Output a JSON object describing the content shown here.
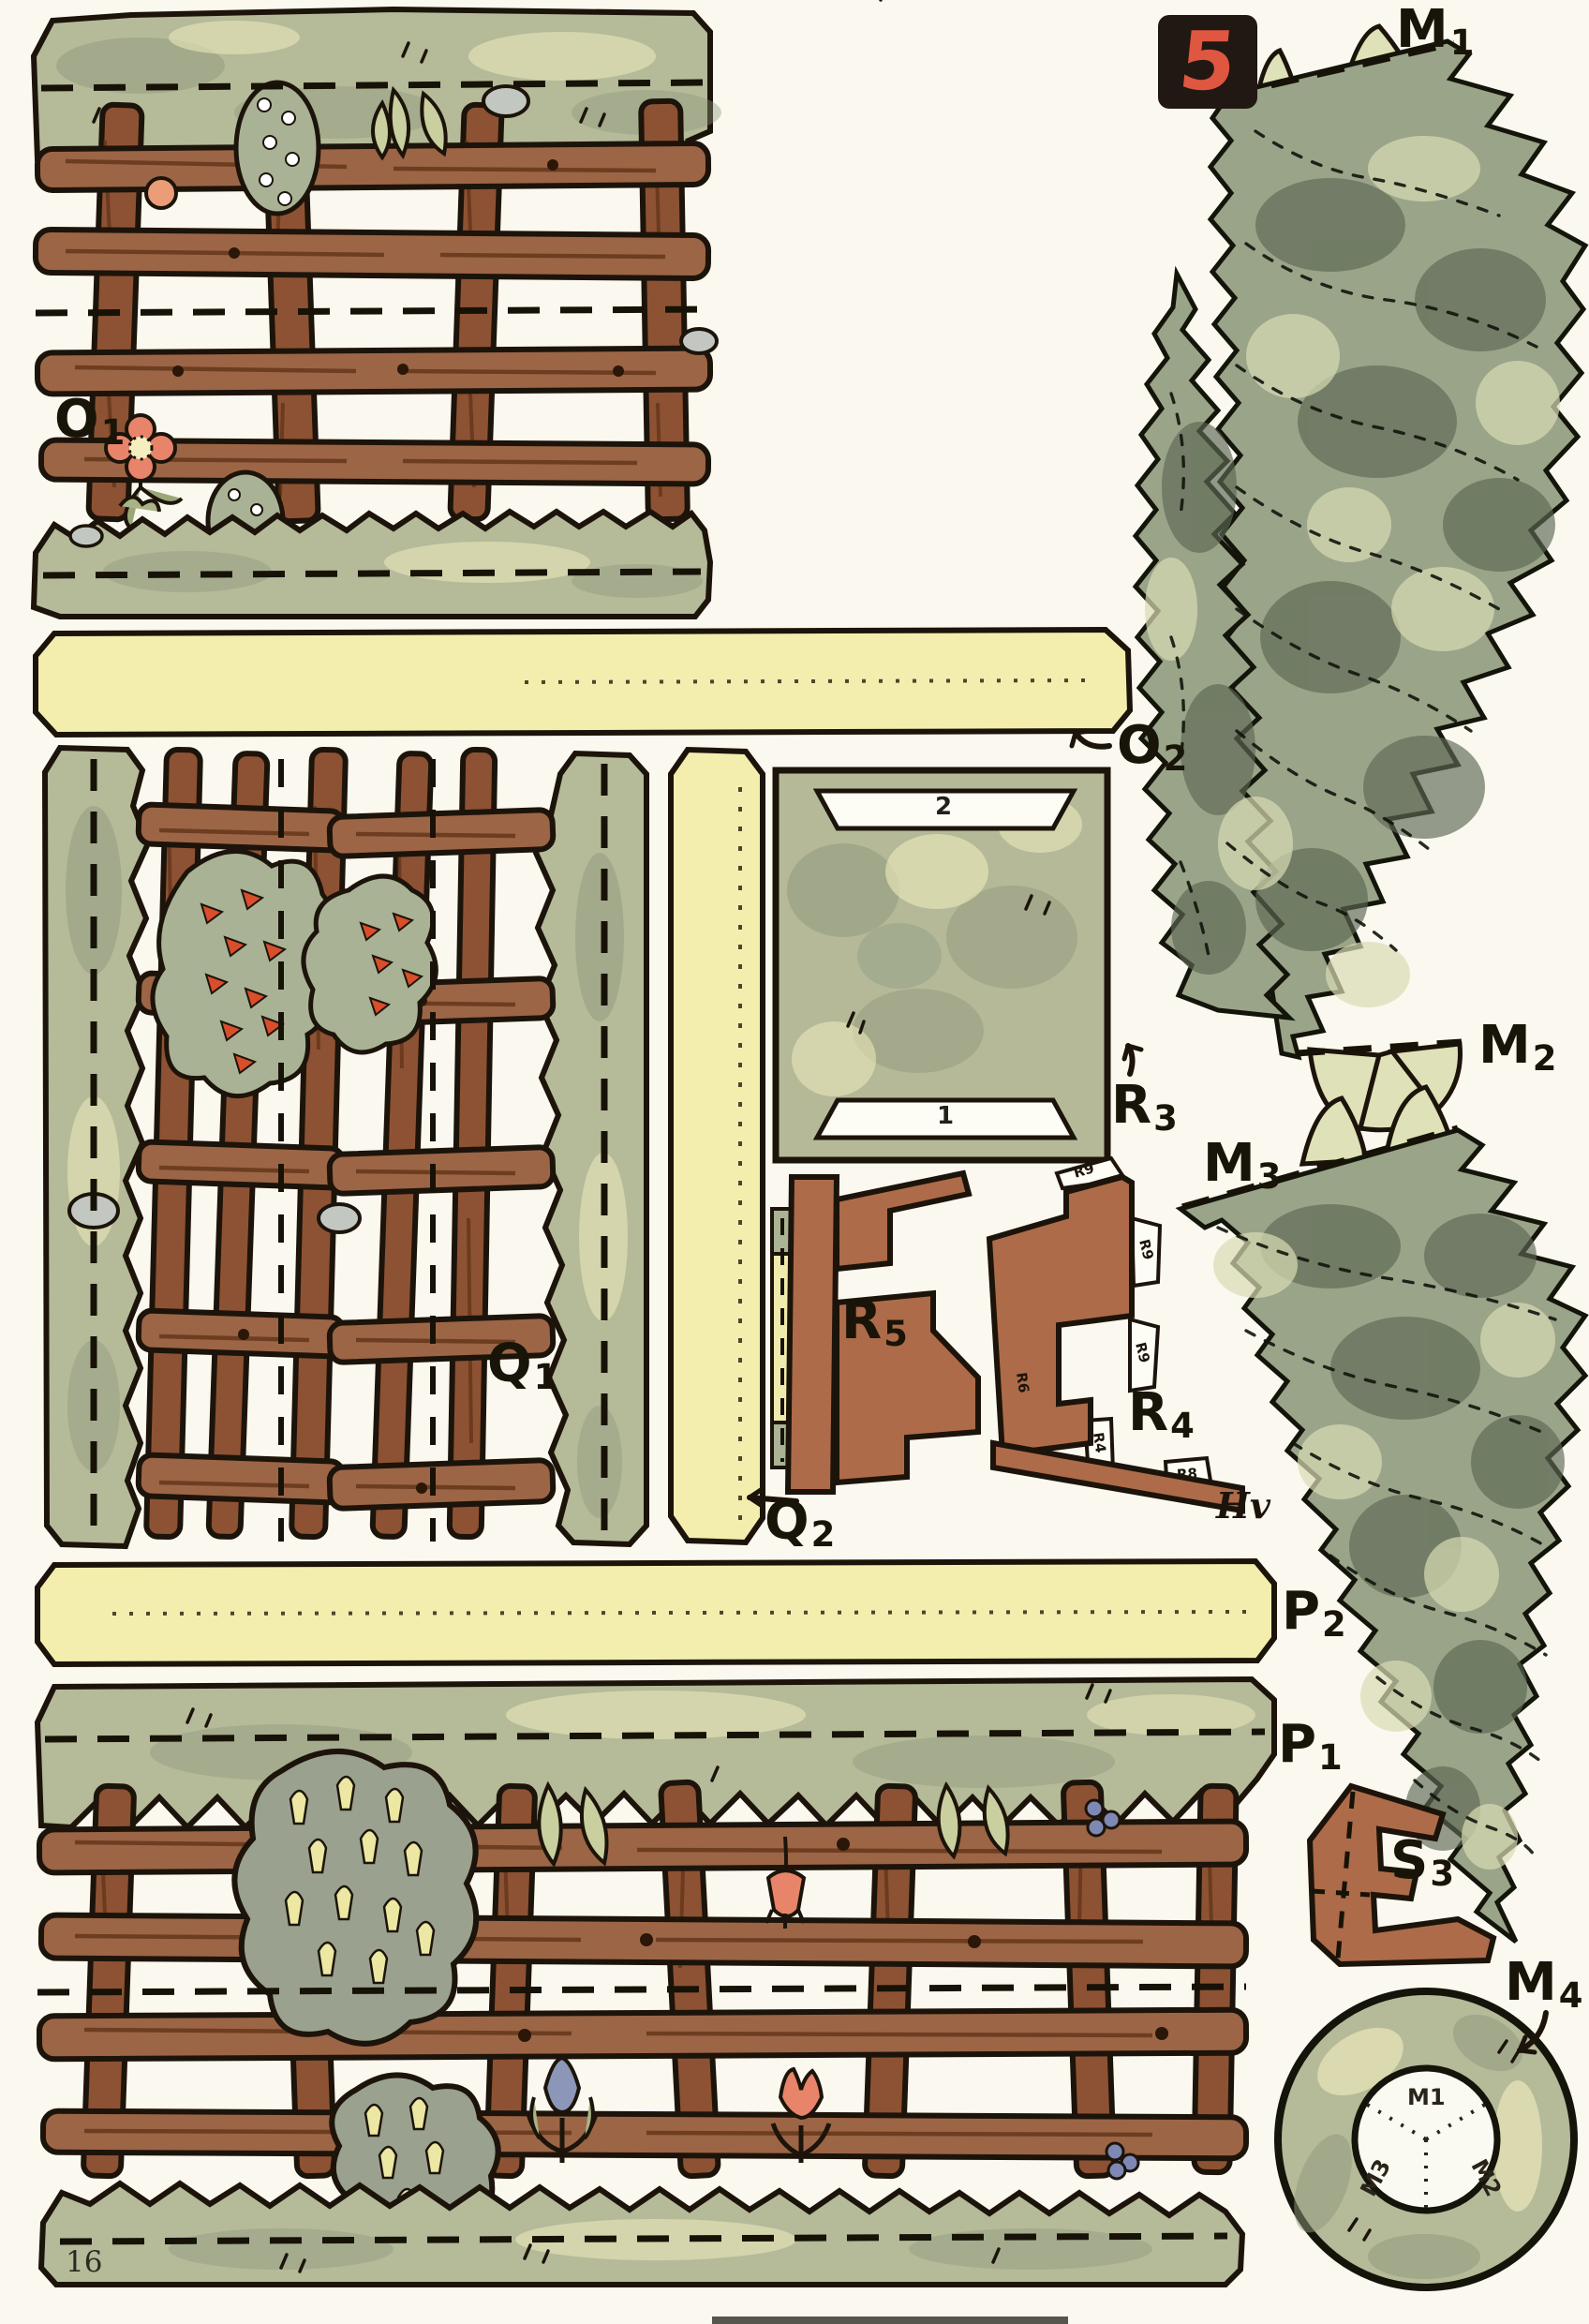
{
  "sheet": {
    "badge_number": "5",
    "page_number": "16",
    "artist_monogram": "Hv"
  },
  "part_labels": {
    "o1": {
      "letter": "O",
      "index": "1"
    },
    "o2": {
      "letter": "O",
      "index": "2"
    },
    "q1": {
      "letter": "Q",
      "index": "1"
    },
    "q2": {
      "letter": "Q",
      "index": "2"
    },
    "r3": {
      "letter": "R",
      "index": "3"
    },
    "r4": {
      "letter": "R",
      "index": "4"
    },
    "r5": {
      "letter": "R",
      "index": "5"
    },
    "p1": {
      "letter": "P",
      "index": "1"
    },
    "p2": {
      "letter": "P",
      "index": "2"
    },
    "s3": {
      "letter": "S",
      "index": "3"
    },
    "m1": {
      "letter": "M",
      "index": "1"
    },
    "m2": {
      "letter": "M",
      "index": "2"
    },
    "m3": {
      "letter": "M",
      "index": "3"
    },
    "m4": {
      "letter": "M",
      "index": "4"
    }
  },
  "glue_tab_labels": {
    "t1": "R9",
    "t2": "R9",
    "t3": "R9",
    "t4": "R6",
    "t5": "R4",
    "t6": "R8"
  },
  "slot_labels": {
    "top_slot": "2",
    "bottom_slot": "1"
  },
  "ring_sector_labels": {
    "top": "M1",
    "lower_right": "M2",
    "lower_left": "M3"
  },
  "colors": {
    "paper": "#faf8ef",
    "grass": "#b5ba99",
    "grass_shadow": "#8e977b",
    "grass_highlight": "#e9e7b9",
    "wood": "#9c6546",
    "wood_dark": "#6b3a20",
    "outline": "#1c140a",
    "fold_tab_yellow": "#f3eead",
    "tree_base": "#9aa489",
    "tree_shadow": "#5c6753",
    "tree_highlight": "#d9dcb4",
    "terracotta": "#ad6b49",
    "badge_background": "#221813",
    "badge_digit": "#df5740",
    "flower_salmon": "#e8846a",
    "flower_red": "#d94e2b",
    "flower_yellow": "#ece7a2",
    "flower_blue": "#7d88b5"
  }
}
